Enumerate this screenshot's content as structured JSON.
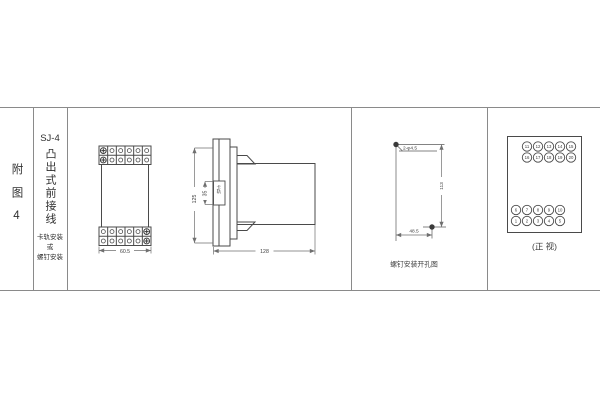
{
  "colors": {
    "background": "#ffffff",
    "drawing_line": "#4a4a4a",
    "dimension_line": "#6f6f6f",
    "frame_line": "#8a8a8a"
  },
  "left_panel": {
    "figure_label": "附图4"
  },
  "title_panel": {
    "model": "SJ-4",
    "title": "凸出式前接线",
    "mount_notes": [
      "卡轨安装",
      "或",
      "螺钉安装"
    ]
  },
  "outline_drawing": {
    "front_width_dim": "60.5",
    "panel_height_dim": "125",
    "rail_height_dim": "35",
    "rail_label": "卡轨",
    "depth_dim": "128"
  },
  "drill_drawing": {
    "holes_label": "2-φ4.5",
    "vertical_dim": "113",
    "horizontal_dim": "48.5",
    "caption": "螺钉安装开孔图"
  },
  "terminal_drawing": {
    "top_rows": [
      [
        "11",
        "12",
        "13",
        "14",
        "15"
      ],
      [
        "16",
        "17",
        "18",
        "19",
        "20"
      ]
    ],
    "bottom_rows": [
      [
        "6",
        "7",
        "8",
        "9",
        "10"
      ],
      [
        "1",
        "2",
        "3",
        "4",
        "5"
      ]
    ],
    "caption": "(正 视)"
  }
}
